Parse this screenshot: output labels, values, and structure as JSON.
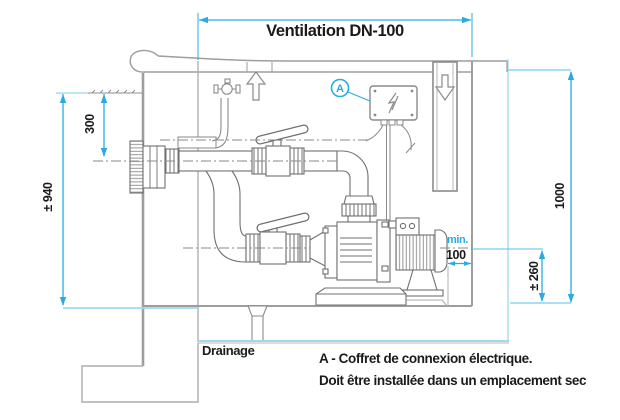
{
  "dimensions": {
    "ventilation_label": "Ventilation DN-100",
    "depth_to_pipe_center": "300",
    "depth_to_floor": "± 940",
    "height_right": "1000",
    "pump_axis_height": "± 260",
    "min_label": "min.",
    "min_clearance": "100"
  },
  "labels": {
    "marker_a": "A",
    "drainage": "Drainage",
    "note_line1": "A - Coffret de connexion électrique.",
    "note_line2": "Doit être installée dans un emplacement sec"
  },
  "icons": {
    "up_arrow": "hollow-arrow-up",
    "down_arrow": "hollow-arrow-down",
    "lightning": "electric-bolt",
    "marker_circle": "circled-A-callout"
  },
  "colors": {
    "dimension_blue": "#29abe2",
    "reference_cyan": "#9fd9f0",
    "structure_gray": "#9e9e9e",
    "equipment_gray": "#707070",
    "text_black": "#1a1a1a",
    "background": "#ffffff"
  }
}
